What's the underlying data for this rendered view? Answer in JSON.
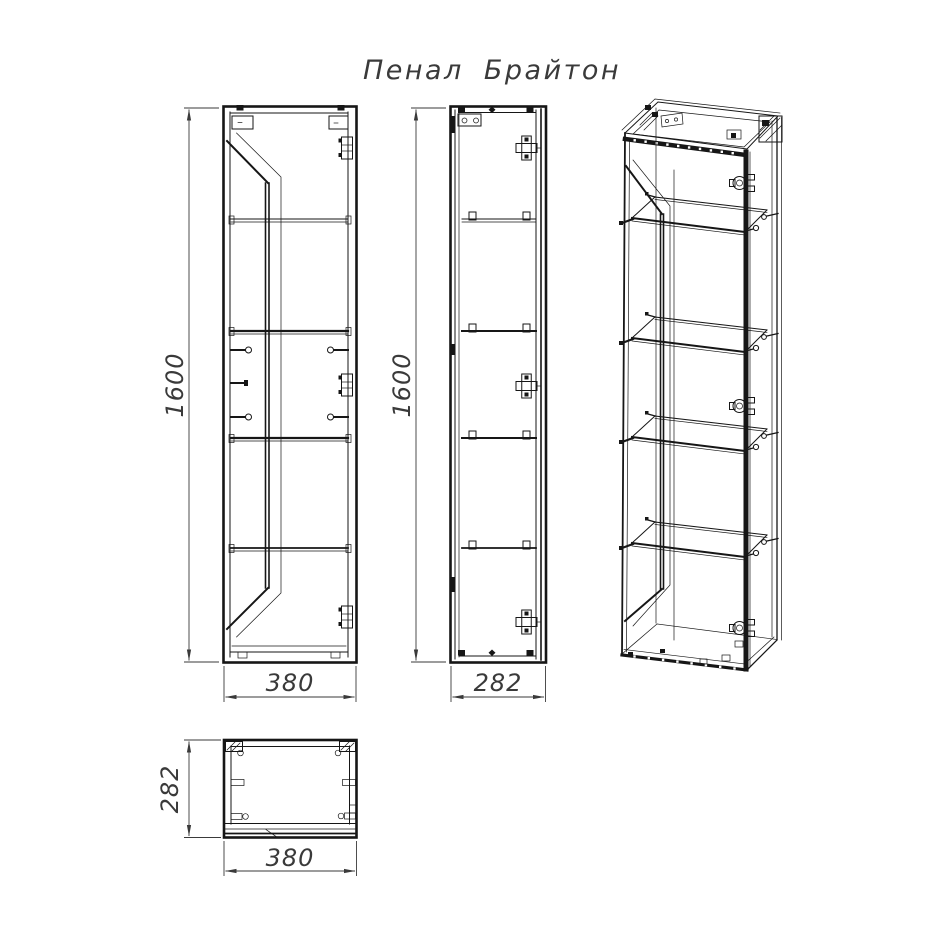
{
  "title": "Пенал Брайтон",
  "dimensions": {
    "front_height": "1600",
    "front_width": "380",
    "side_height": "1600",
    "side_depth": "282",
    "top_depth": "282",
    "top_width": "380"
  },
  "colors": {
    "line": "#161616",
    "dimension": "#3a3a3a",
    "background": "#ffffff"
  }
}
